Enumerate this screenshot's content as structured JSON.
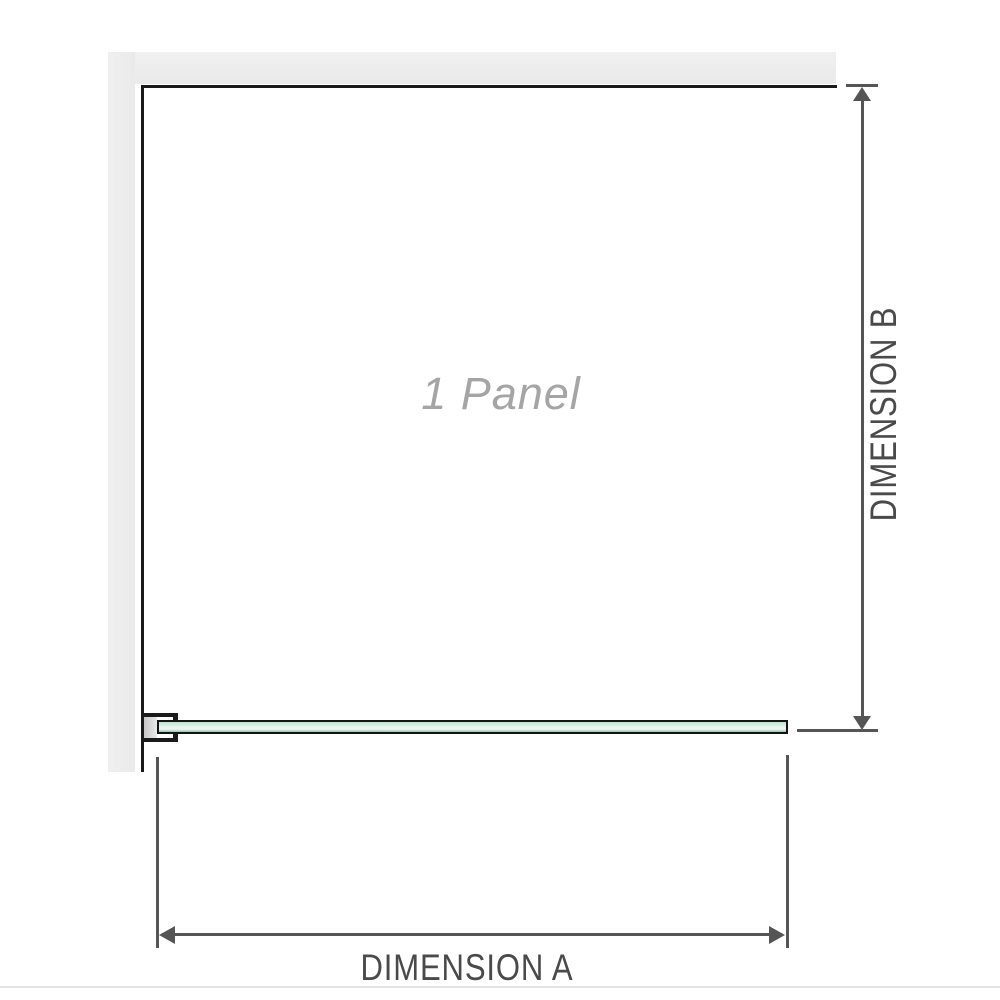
{
  "diagram": {
    "panel_label": "1 Panel",
    "dimension_a_label": "DIMENSION A",
    "dimension_b_label": "DIMENSION B"
  },
  "colors": {
    "wall": "#eaeaea",
    "wall_light": "#f0f0f0",
    "outline": "#1a1a1a",
    "dimension": "#555555",
    "label_text": "#4a4a4a",
    "panel_label_text": "#a5a5a5",
    "glass_top": "#bfe3cf",
    "glass_mid": "#eef8f2",
    "glass_bottom": "#9cbcad"
  }
}
